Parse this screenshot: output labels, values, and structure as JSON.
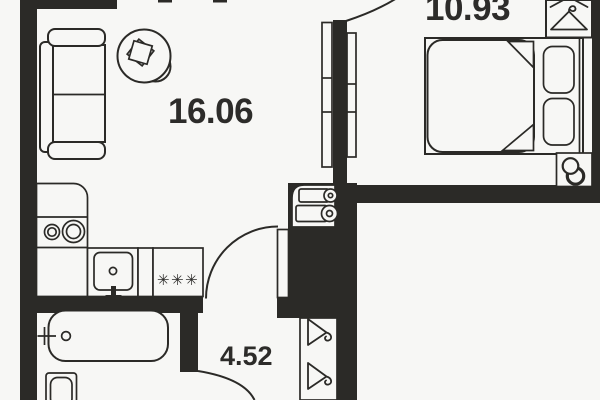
{
  "plan": {
    "rooms": [
      {
        "id": "living-room",
        "area": "16.06"
      },
      {
        "id": "bedroom",
        "area": "10.93"
      },
      {
        "id": "hallway",
        "area": "4.52"
      }
    ],
    "stove_symbol": "✳✳✳"
  },
  "icons": {
    "closet": "hanger-icon",
    "wardrobe": "hanger-icon",
    "stove": "burner-asterisks",
    "riser": "pipe-riser-icon",
    "boiler": "water-heater-icon"
  },
  "colors": {
    "wall": "#2b2a27",
    "paper": "#f7f7f5",
    "text": "#2d2c2a"
  }
}
